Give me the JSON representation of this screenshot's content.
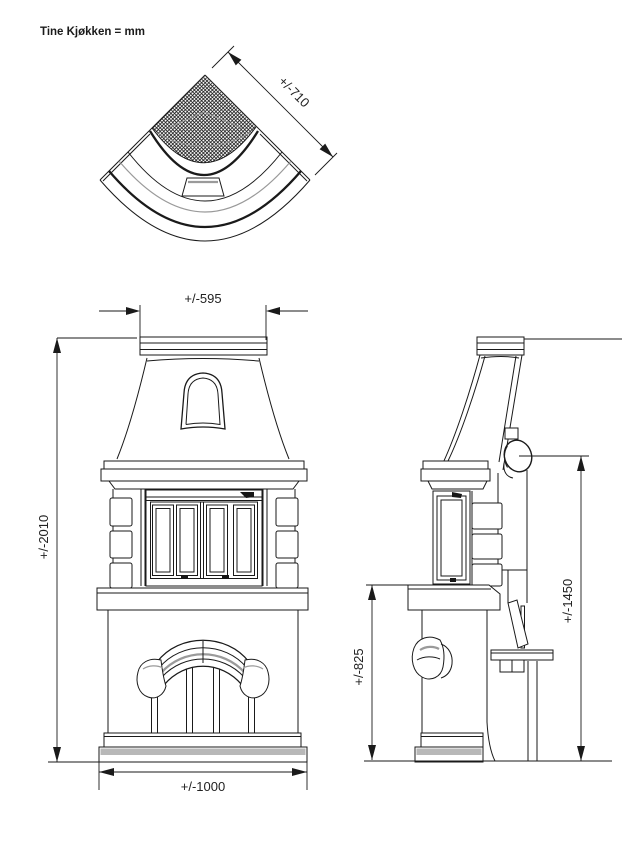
{
  "title": "Tine Kjøkken = mm",
  "dimensions": {
    "top_depth": "+/-710",
    "cap_width": "+/-595",
    "total_height": "+/-2010",
    "base_width": "+/-1000",
    "hearth_height": "+/-825",
    "flue_height": "+/-1450"
  },
  "colors": {
    "line": "#1a1a1a",
    "gray_fill": "#b8b8b8",
    "gray_line": "#9a9a9a",
    "background": "#ffffff"
  }
}
